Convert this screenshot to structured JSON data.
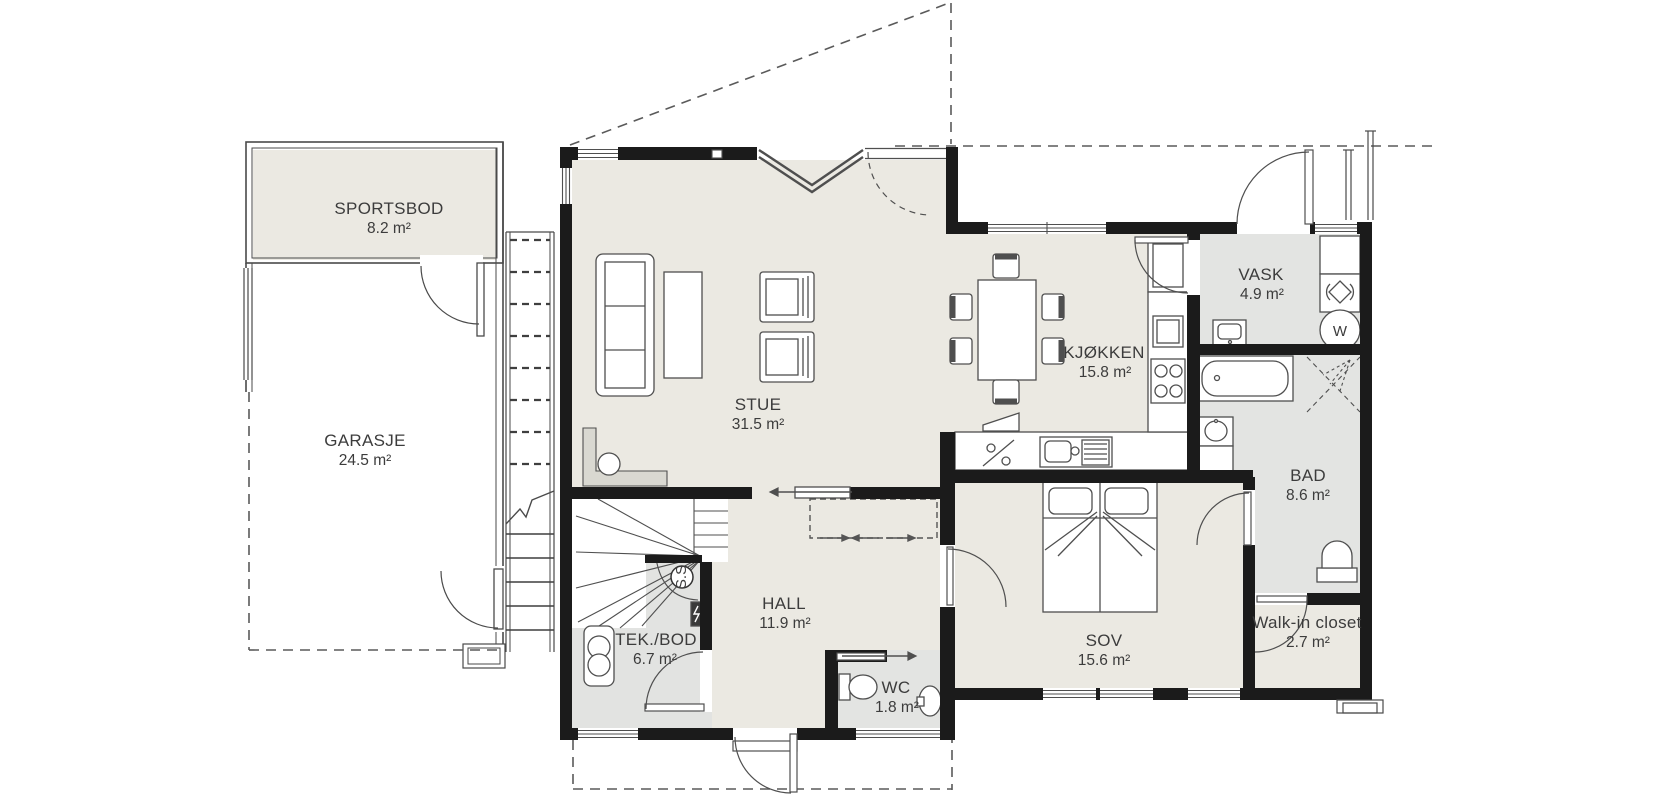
{
  "plan": {
    "rooms": [
      {
        "id": "sportsbod",
        "name": "SPORTSBOD",
        "area": "8.2 m²"
      },
      {
        "id": "garasje",
        "name": "GARASJE",
        "area": "24.5 m²"
      },
      {
        "id": "stue",
        "name": "STUE",
        "area": "31.5 m²"
      },
      {
        "id": "kjokken",
        "name": "KJØKKEN",
        "area": "15.8 m²"
      },
      {
        "id": "vask",
        "name": "VASK",
        "area": "4.9 m²"
      },
      {
        "id": "bad",
        "name": "BAD",
        "area": "8.6 m²"
      },
      {
        "id": "hall",
        "name": "HALL",
        "area": "11.9 m²"
      },
      {
        "id": "tekbod",
        "name": "TEK./BOD",
        "area": "6.7 m²"
      },
      {
        "id": "wc",
        "name": "WC",
        "area": "1.8 m²"
      },
      {
        "id": "sov",
        "name": "SOV",
        "area": "15.6 m²"
      },
      {
        "id": "walkin",
        "name": "Walk-in closet",
        "area": "2.7 m²"
      }
    ],
    "symbols": {
      "washing_machine": "W",
      "stair_circle": "S.S"
    },
    "colors": {
      "wall": "#1b1b1b",
      "floor_living": "#ebe9e2",
      "floor_wet": "#e3e4e2",
      "line": "#4f4f4f",
      "background": "#ffffff"
    }
  }
}
